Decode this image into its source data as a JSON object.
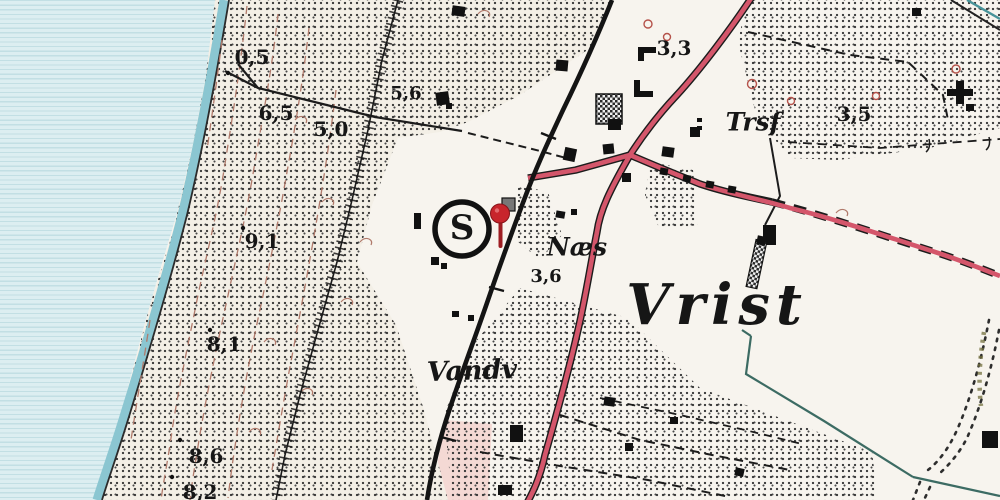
{
  "map": {
    "place_labels": [
      {
        "id": "vrist",
        "text": "Vrist"
      },
      {
        "id": "naes",
        "text": "Næs"
      },
      {
        "id": "vandv",
        "text": "Vandv"
      },
      {
        "id": "trsf",
        "text": "Trsf"
      }
    ],
    "station_symbol": "S",
    "spot_heights": [
      {
        "text": "0,5"
      },
      {
        "text": "6,5"
      },
      {
        "text": "5,0"
      },
      {
        "text": "5,6"
      },
      {
        "text": "9,1"
      },
      {
        "text": "8,1"
      },
      {
        "text": "8,6"
      },
      {
        "text": "8,2"
      },
      {
        "text": "3,3"
      },
      {
        "text": "3,5"
      },
      {
        "text": "3,6"
      }
    ],
    "marker": {
      "type": "red-pin",
      "color": "#c8252c"
    },
    "colors": {
      "water": "#dceef1",
      "water_ruling": "#c2dfe4",
      "shore_band": "#8bc6d1",
      "land": "#f7f4ee",
      "dune_land": "#f3efe6",
      "road_red": "#d4566b",
      "pink_block": "#f4d9d4",
      "contour_brown": "#b07a6b",
      "ditch_teal": "#3c6b63",
      "stream_teal": "#48949a",
      "pin_red": "#c8252c"
    }
  }
}
